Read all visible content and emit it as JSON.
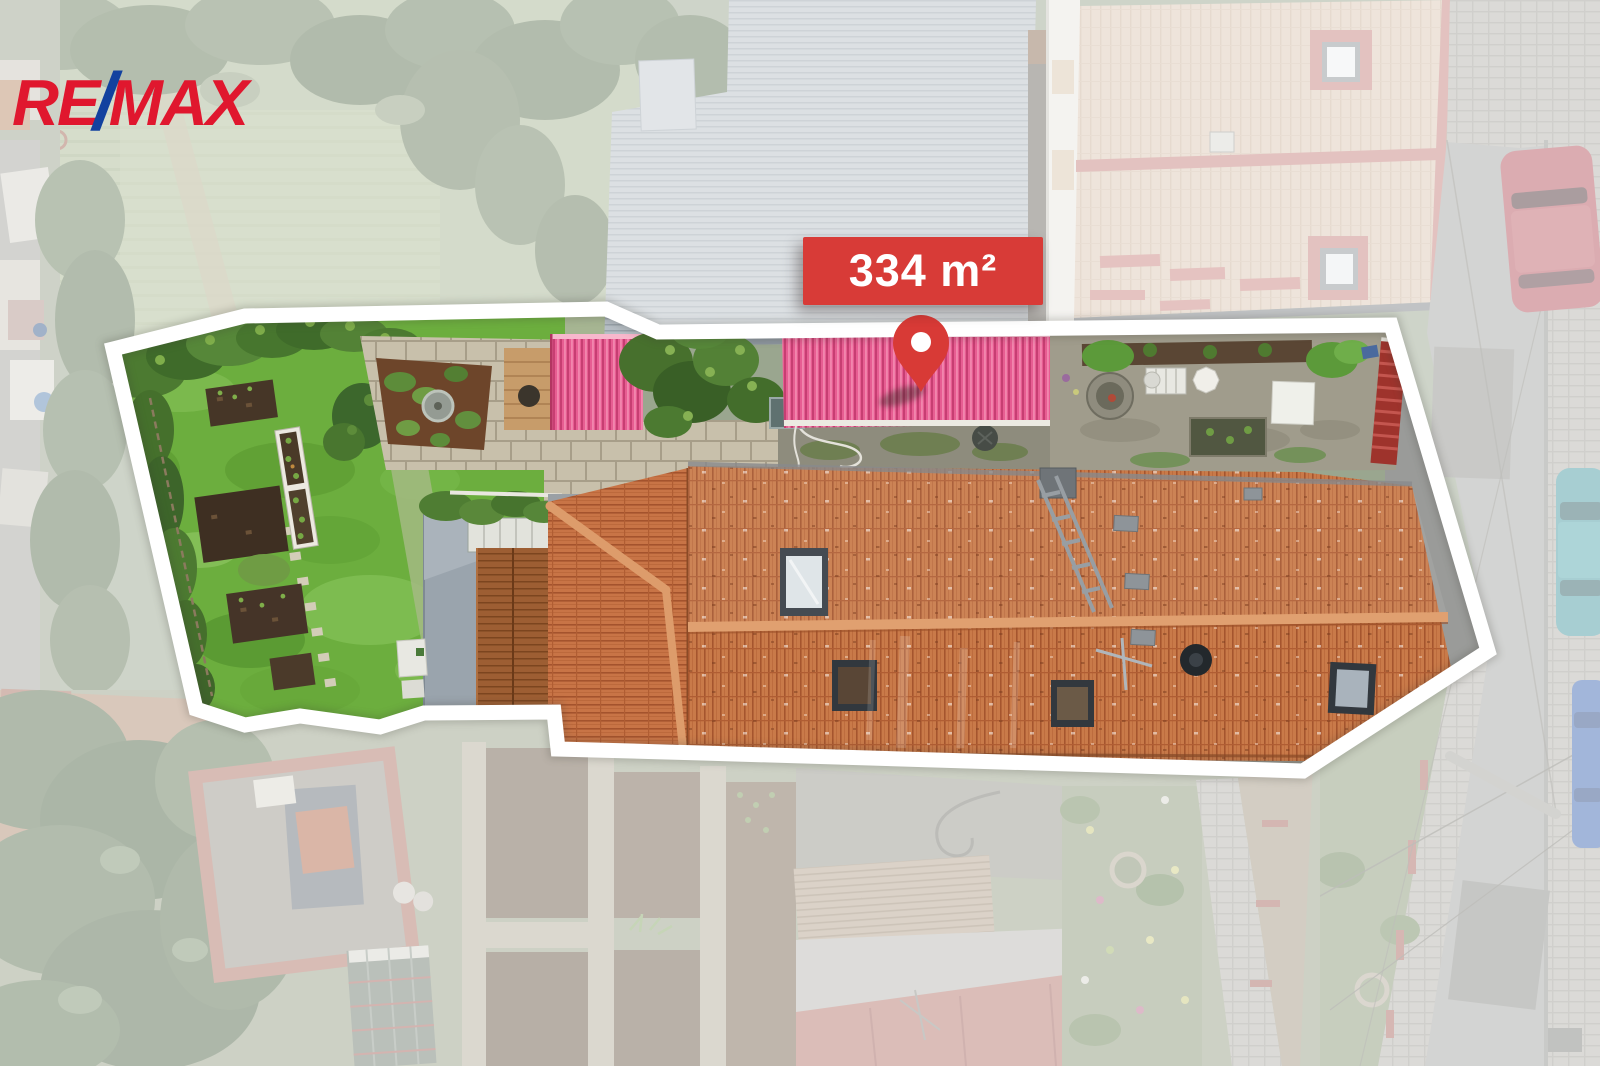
{
  "branding": {
    "logo_re": "RE",
    "logo_slash": "/",
    "logo_max": "MAX",
    "logo_red_color": "#E0172E",
    "logo_blue_color": "#12419F"
  },
  "listing": {
    "area_label": "334 m²",
    "label_background": "#D83B37",
    "label_text_color": "#FFFFFF",
    "pin_color": "#D83A36",
    "outline_color": "#FFFFFF"
  }
}
